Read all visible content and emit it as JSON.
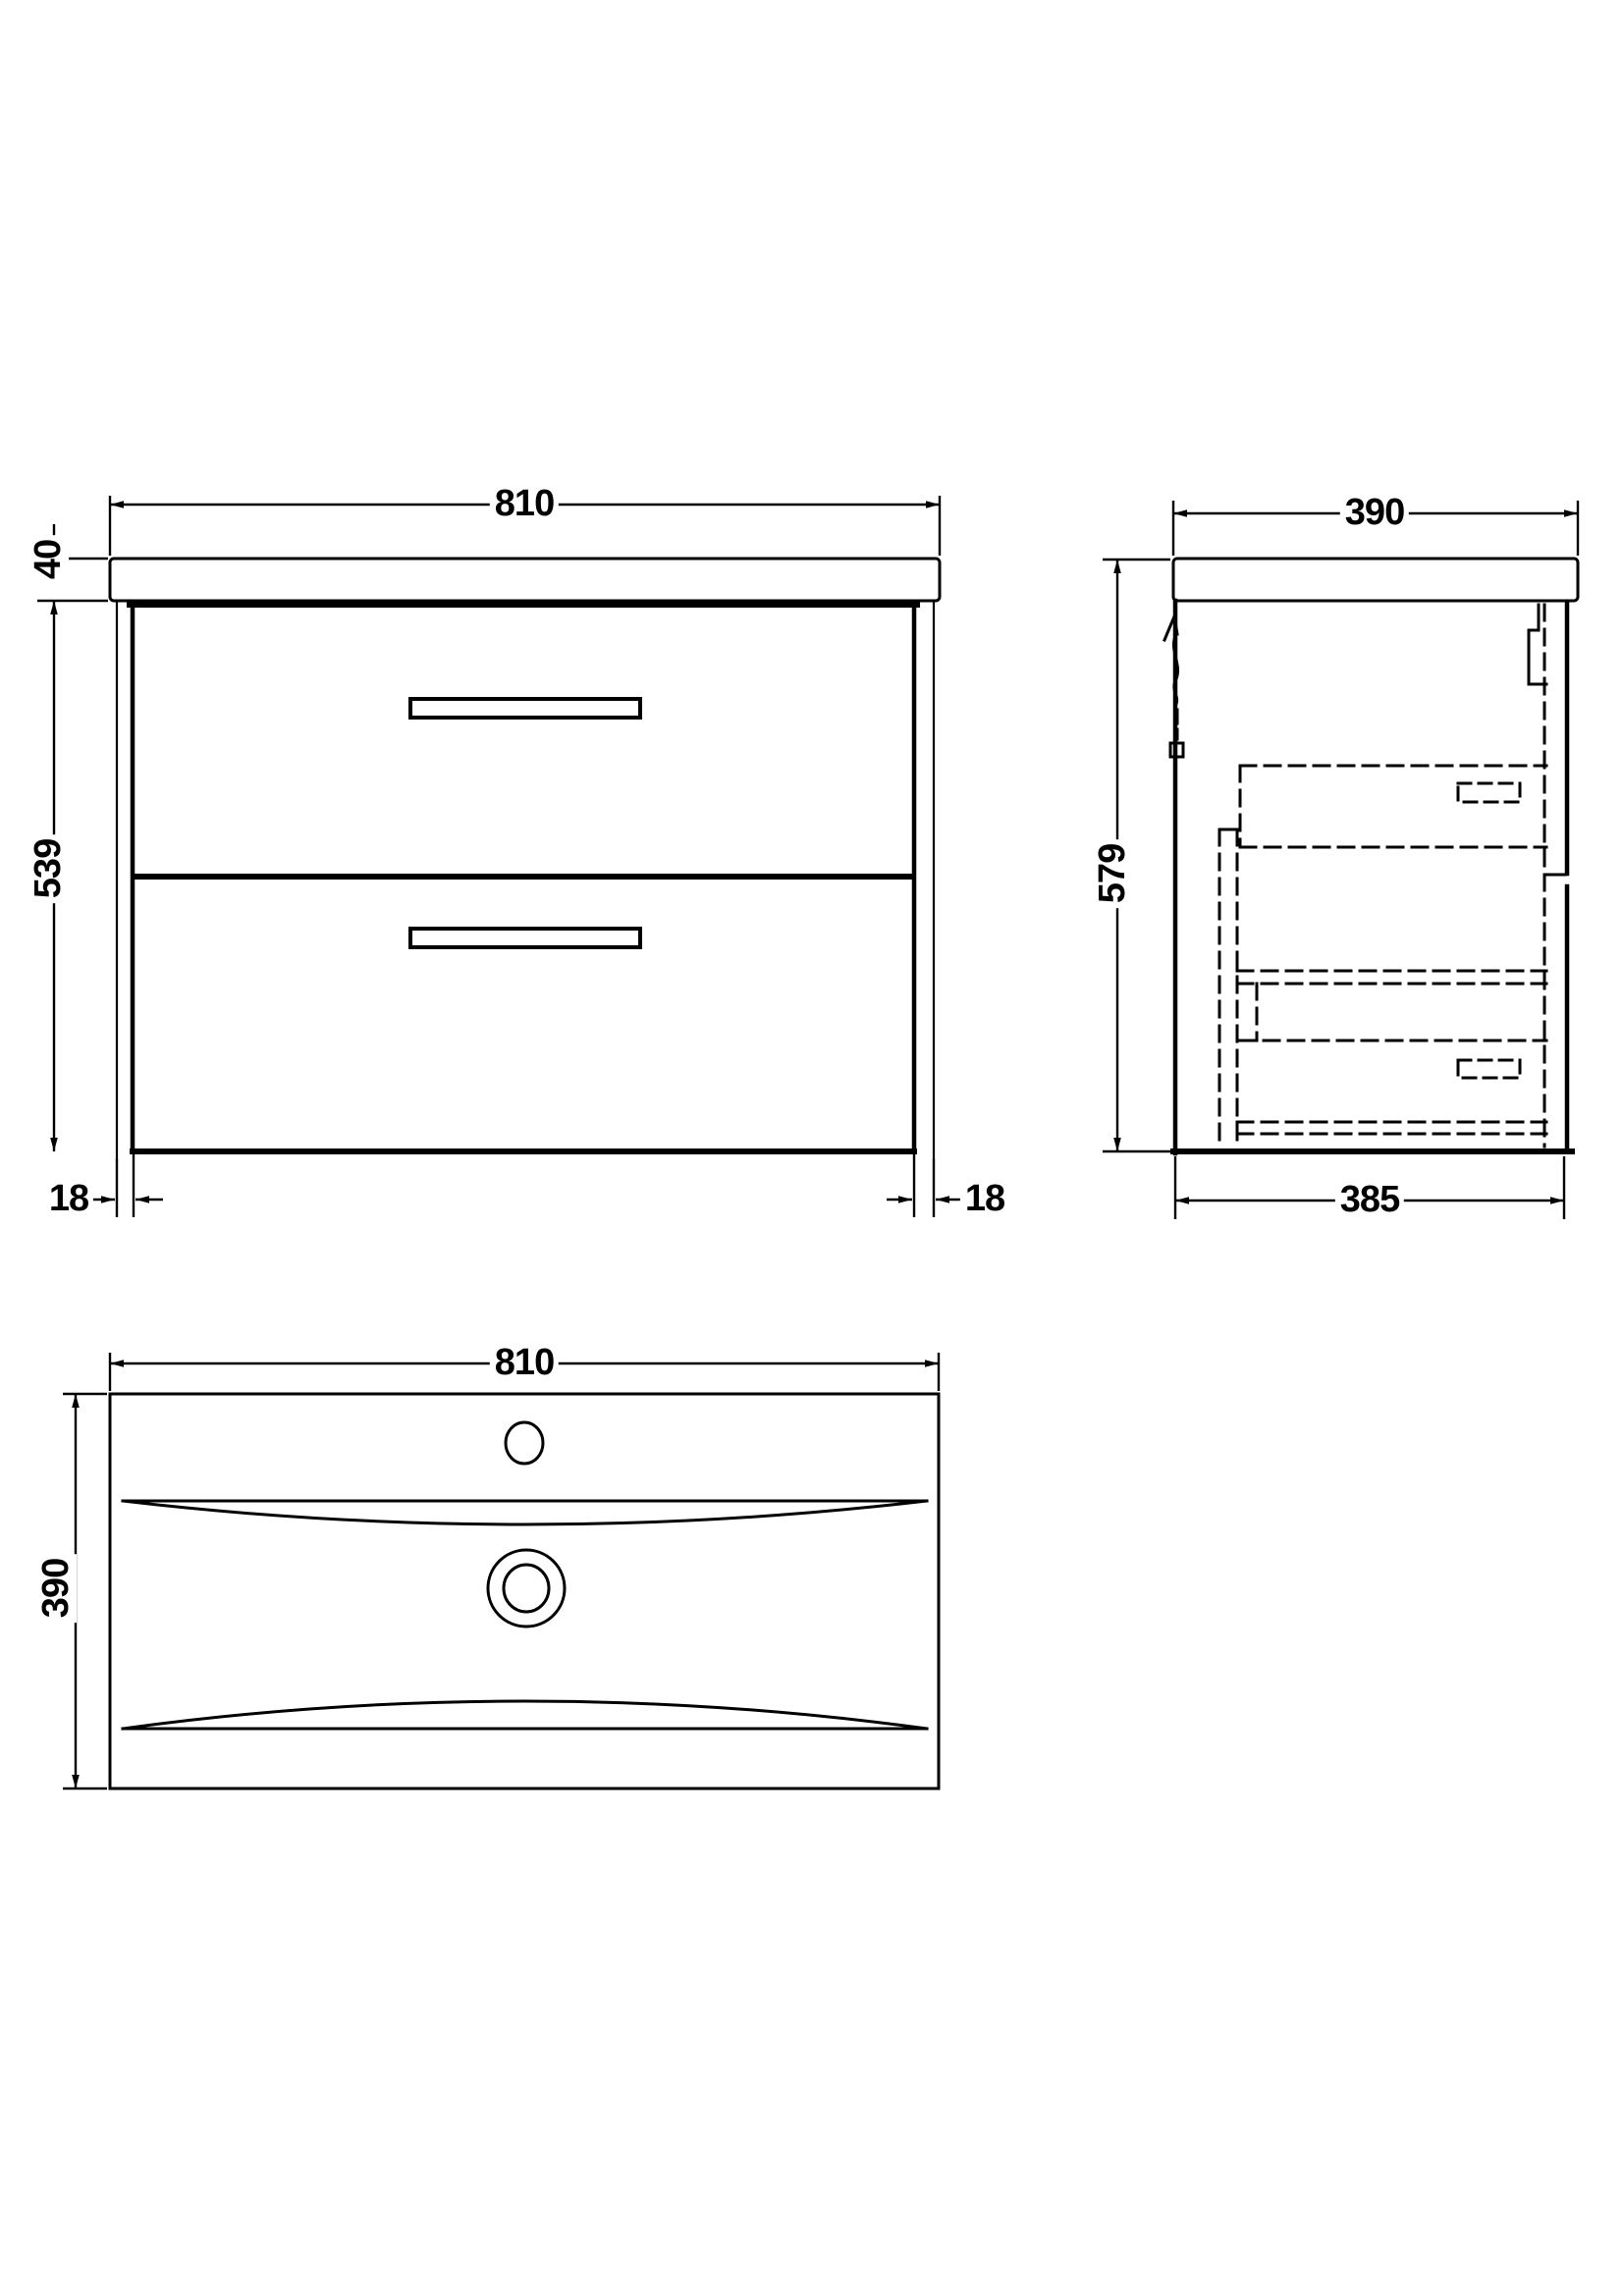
{
  "drawing": {
    "type": "technical dimension drawing",
    "product": "wall-hung two-drawer vanity unit with basin",
    "units": "mm",
    "line_color": "#000000",
    "background_color": "#ffffff",
    "front_view": {
      "name": "front elevation",
      "width": "810",
      "worktop_thickness": "40",
      "cabinet_height": "539",
      "left_panel": "18",
      "right_panel": "18"
    },
    "side_view": {
      "name": "side elevation",
      "depth": "390",
      "overall_height": "579",
      "cabinet_depth": "385"
    },
    "plan_view": {
      "name": "basin plan view",
      "width": "810",
      "depth": "390"
    }
  }
}
